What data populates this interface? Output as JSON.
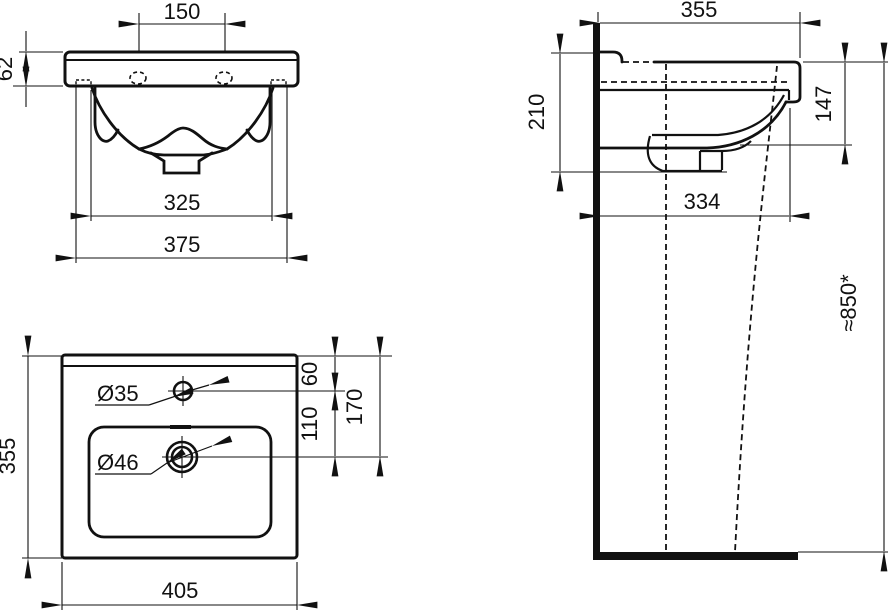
{
  "drawing": {
    "front_view": {
      "dims": {
        "tap_hole_spacing": "150",
        "apron_height": "62",
        "fixing_inner_width": "325",
        "fixing_outer_width": "375"
      }
    },
    "plan_view": {
      "dims": {
        "depth": "355",
        "width": "405",
        "tap_hole_diameter": "Ø35",
        "waste_hole_diameter": "Ø46",
        "tap_offset_from_back": "60",
        "tap_to_waste": "110",
        "waste_offset_from_back": "170"
      }
    },
    "side_view": {
      "dims": {
        "depth": "355",
        "basin_front_height": "147",
        "basin_total_height": "210",
        "underside_depth": "334",
        "rim_height_from_floor": "≈850*"
      }
    },
    "colors": {
      "line": "#111111",
      "background": "#ffffff"
    }
  }
}
